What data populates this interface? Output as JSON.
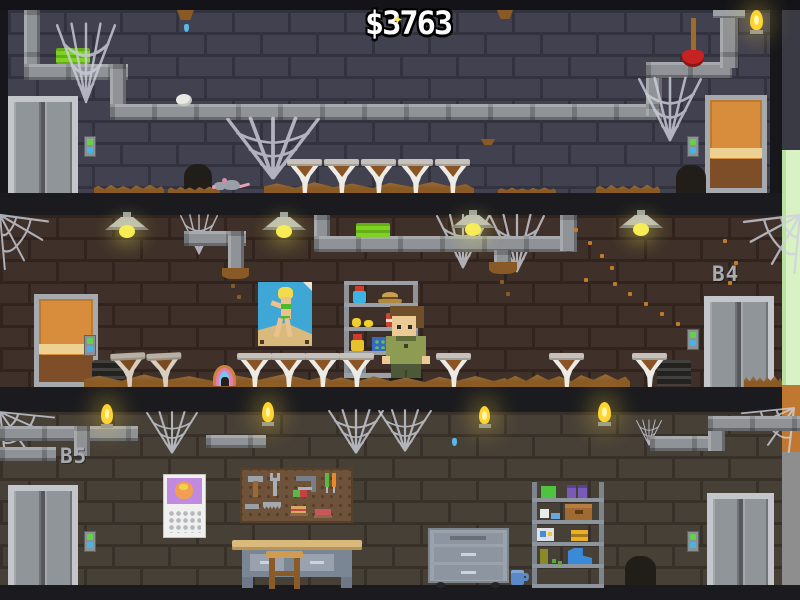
{
  "hud": {
    "money": "$3763"
  },
  "floors": {
    "top": {
      "label": ""
    },
    "middle": {
      "label": "B4"
    },
    "bottom": {
      "label": "B5"
    }
  },
  "palette": {
    "wall_top": "#414150",
    "wall_middle": "#3f3129",
    "wall_bottom": "#474037",
    "floor_band": "#1b1b1f",
    "dirt": "#8a5a24",
    "pipe": "#8f9296",
    "slime_green": "#7ed321",
    "lamp_yellow": "#f7ec55",
    "plunger_red": "#c62222",
    "door_orange": "#d78d3b",
    "elevator_gray": "#909599",
    "edge_grass": "#d8f2c4",
    "edge_dirt": "#c07830",
    "edge_stone": "#8e8e8e",
    "money_text": "#ffffff",
    "label_gray": "#a8acb2"
  },
  "scene": {
    "objects": [
      {
        "t": "pipeV",
        "n": "pipe-vertical",
        "x": 24,
        "y": 10,
        "w": 16,
        "h": 60
      },
      {
        "t": "pipeH",
        "n": "pipe-horizontal",
        "x": 24,
        "y": 64,
        "w": 104,
        "h": 16
      },
      {
        "t": "pipeV",
        "n": "pipe-vertical",
        "x": 110,
        "y": 64,
        "w": 16,
        "h": 52
      },
      {
        "t": "pipeH",
        "n": "pipe-horizontal",
        "x": 110,
        "y": 104,
        "w": 552,
        "h": 16
      },
      {
        "t": "pipeV",
        "n": "pipe-vertical",
        "x": 646,
        "y": 62,
        "w": 16,
        "h": 54
      },
      {
        "t": "pipeH",
        "n": "pipe-horizontal",
        "x": 646,
        "y": 62,
        "w": 86,
        "h": 16
      },
      {
        "t": "pipeV",
        "n": "pipe-vertical",
        "x": 720,
        "y": 10,
        "w": 18,
        "h": 58
      },
      {
        "t": "flange",
        "n": "pipe-flange",
        "x": 713,
        "y": 10,
        "w": 32,
        "h": 8
      },
      {
        "t": "sponge",
        "n": "green-slime-block",
        "x": 56,
        "y": 48,
        "w": 34,
        "h": 16,
        "i": true
      },
      {
        "t": "egg",
        "n": "spider-egg",
        "x": 176,
        "y": 94,
        "w": 16,
        "h": 12
      },
      {
        "t": "clump",
        "n": "dirt-clump",
        "x": 177,
        "y": 10,
        "w": 17,
        "h": 10
      },
      {
        "t": "clump",
        "n": "dirt-clump",
        "x": 497,
        "y": 10,
        "w": 16,
        "h": 9
      },
      {
        "t": "clump",
        "n": "dirt-clump",
        "x": 481,
        "y": 139,
        "w": 14,
        "h": 6
      },
      {
        "t": "drip",
        "n": "water-drip",
        "x": 184,
        "y": 24,
        "w": 5,
        "h": 8
      },
      {
        "t": "web",
        "v": "hang",
        "n": "spider-web",
        "x": 56,
        "y": 24,
        "w": 60,
        "h": 80
      },
      {
        "t": "web",
        "v": "hang",
        "n": "spider-web",
        "x": 226,
        "y": 118,
        "w": 94,
        "h": 62
      },
      {
        "t": "web",
        "v": "hang",
        "n": "spider-web",
        "x": 638,
        "y": 78,
        "w": 64,
        "h": 64
      },
      {
        "t": "plunger",
        "n": "plunger",
        "x": 682,
        "y": 18,
        "w": 22,
        "h": 49,
        "i": true
      },
      {
        "t": "flame",
        "n": "wall-torch-flame",
        "x": 748,
        "y": 10,
        "w": 17,
        "h": 24
      },
      {
        "t": "elev",
        "n": "elevator-door",
        "x": 8,
        "y": 96,
        "w": 70,
        "h": 97,
        "i": true
      },
      {
        "t": "btn",
        "n": "elevator-call-button",
        "x": 84,
        "y": 136,
        "w": 12,
        "h": 21,
        "i": true
      },
      {
        "t": "wdoor",
        "n": "wooden-door",
        "x": 705,
        "y": 95,
        "w": 62,
        "h": 98,
        "i": true
      },
      {
        "t": "btn",
        "n": "door-button",
        "x": 687,
        "y": 136,
        "w": 12,
        "h": 21,
        "i": true
      },
      {
        "t": "hole",
        "n": "mouse-hole",
        "x": 184,
        "y": 164,
        "w": 28,
        "h": 29
      },
      {
        "t": "hole",
        "n": "mouse-hole",
        "x": 676,
        "y": 165,
        "w": 30,
        "h": 28
      },
      {
        "t": "dirt",
        "n": "dirt-pile",
        "x": 94,
        "y": 184,
        "w": 70,
        "h": 9
      },
      {
        "t": "dirt",
        "n": "dirt-pile",
        "x": 168,
        "y": 186,
        "w": 52,
        "h": 7
      },
      {
        "t": "dirt",
        "n": "dirt-pile",
        "x": 264,
        "y": 181,
        "w": 210,
        "h": 12
      },
      {
        "t": "dirt",
        "n": "dirt-pile",
        "x": 498,
        "y": 187,
        "w": 58,
        "h": 6
      },
      {
        "t": "dirt",
        "n": "dirt-pile",
        "x": 596,
        "y": 184,
        "w": 64,
        "h": 9
      },
      {
        "t": "mouse",
        "n": "rat",
        "x": 212,
        "y": 176,
        "w": 38,
        "h": 17,
        "i": true
      },
      {
        "t": "cone",
        "n": "funnel-planter",
        "x": 287,
        "y": 157,
        "w": 35,
        "h": 36,
        "i": true
      },
      {
        "t": "cone",
        "n": "funnel-planter",
        "x": 324,
        "y": 157,
        "w": 35,
        "h": 36,
        "i": true
      },
      {
        "t": "cone",
        "n": "funnel-planter",
        "x": 361,
        "y": 157,
        "w": 35,
        "h": 36,
        "i": true
      },
      {
        "t": "cone",
        "n": "funnel-planter",
        "x": 398,
        "y": 157,
        "w": 35,
        "h": 36,
        "i": true
      },
      {
        "t": "cone",
        "n": "funnel-planter",
        "x": 435,
        "y": 157,
        "w": 35,
        "h": 36,
        "i": true
      },
      {
        "t": "web",
        "v": "tl",
        "n": "spider-web",
        "x": 0,
        "y": 215,
        "w": 48,
        "h": 54
      },
      {
        "t": "web",
        "v": "hang",
        "n": "spider-web",
        "x": 180,
        "y": 215,
        "w": 38,
        "h": 40
      },
      {
        "t": "web",
        "v": "hang",
        "n": "spider-web",
        "x": 436,
        "y": 215,
        "w": 54,
        "h": 54
      },
      {
        "t": "web",
        "v": "hang",
        "n": "spider-web",
        "x": 489,
        "y": 215,
        "w": 56,
        "h": 58
      },
      {
        "t": "web",
        "v": "tr",
        "n": "spider-web",
        "x": 744,
        "y": 215,
        "w": 56,
        "h": 58
      },
      {
        "t": "pipeH",
        "n": "pipe-horizontal",
        "x": 184,
        "y": 231,
        "w": 62,
        "h": 15
      },
      {
        "t": "pipeV",
        "n": "pipe-vertical",
        "x": 228,
        "y": 231,
        "w": 16,
        "h": 40
      },
      {
        "t": "leak",
        "n": "pipe-leak",
        "x": 222,
        "y": 268,
        "w": 27,
        "h": 11
      },
      {
        "t": "speck",
        "n": "debris-speck",
        "x": 231,
        "y": 284,
        "w": 4,
        "h": 4,
        "c": "#8a5a26"
      },
      {
        "t": "speck",
        "n": "debris-speck",
        "x": 237,
        "y": 295,
        "w": 4,
        "h": 4,
        "c": "#8a5a26"
      },
      {
        "t": "pipeV",
        "n": "pipe-vertical",
        "x": 314,
        "y": 215,
        "w": 16,
        "h": 36
      },
      {
        "t": "pipeH",
        "n": "pipe-horizontal",
        "x": 314,
        "y": 236,
        "w": 263,
        "h": 16
      },
      {
        "t": "pipeV",
        "n": "pipe-vertical",
        "x": 560,
        "y": 215,
        "w": 17,
        "h": 36
      },
      {
        "t": "pipeV",
        "n": "pipe-vertical",
        "x": 494,
        "y": 250,
        "w": 17,
        "h": 14
      },
      {
        "t": "leak",
        "n": "pipe-leak",
        "x": 489,
        "y": 262,
        "w": 28,
        "h": 12
      },
      {
        "t": "speck",
        "n": "debris-speck",
        "x": 500,
        "y": 280,
        "w": 4,
        "h": 4,
        "c": "#8a5a26"
      },
      {
        "t": "speck",
        "n": "debris-speck",
        "x": 506,
        "y": 292,
        "w": 4,
        "h": 4,
        "c": "#8a5a26"
      },
      {
        "t": "sponge",
        "n": "green-slime-block",
        "x": 356,
        "y": 223,
        "w": 34,
        "h": 14,
        "i": true
      },
      {
        "t": "lamp",
        "n": "ceiling-lamp",
        "x": 105,
        "y": 212,
        "w": 44,
        "h": 28
      },
      {
        "t": "lamp",
        "n": "ceiling-lamp",
        "x": 262,
        "y": 212,
        "w": 44,
        "h": 28
      },
      {
        "t": "lamp",
        "n": "ceiling-lamp",
        "x": 451,
        "y": 210,
        "w": 44,
        "h": 28
      },
      {
        "t": "lamp",
        "n": "ceiling-lamp",
        "x": 619,
        "y": 210,
        "w": 44,
        "h": 28
      },
      {
        "t": "speck",
        "n": "sawdust-speck",
        "x": 574,
        "y": 228,
        "w": 4,
        "h": 4,
        "c": "#c07a28"
      },
      {
        "t": "speck",
        "n": "sawdust-speck",
        "x": 588,
        "y": 241,
        "w": 4,
        "h": 4,
        "c": "#c07a28"
      },
      {
        "t": "speck",
        "n": "sawdust-speck",
        "x": 600,
        "y": 254,
        "w": 4,
        "h": 4,
        "c": "#c07a28"
      },
      {
        "t": "speck",
        "n": "sawdust-speck",
        "x": 610,
        "y": 266,
        "w": 4,
        "h": 4,
        "c": "#c07a28"
      },
      {
        "t": "speck",
        "n": "sawdust-speck",
        "x": 584,
        "y": 278,
        "w": 4,
        "h": 4,
        "c": "#c07a28"
      },
      {
        "t": "speck",
        "n": "sawdust-speck",
        "x": 613,
        "y": 282,
        "w": 4,
        "h": 4,
        "c": "#c07a28"
      },
      {
        "t": "speck",
        "n": "sawdust-speck",
        "x": 628,
        "y": 292,
        "w": 4,
        "h": 4,
        "c": "#c07a28"
      },
      {
        "t": "speck",
        "n": "sawdust-speck",
        "x": 644,
        "y": 302,
        "w": 4,
        "h": 4,
        "c": "#c07a28"
      },
      {
        "t": "speck",
        "n": "sawdust-speck",
        "x": 660,
        "y": 312,
        "w": 4,
        "h": 4,
        "c": "#c07a28"
      },
      {
        "t": "speck",
        "n": "sawdust-speck",
        "x": 676,
        "y": 322,
        "w": 4,
        "h": 4,
        "c": "#c07a28"
      },
      {
        "t": "speck",
        "n": "sawdust-speck",
        "x": 692,
        "y": 330,
        "w": 4,
        "h": 4,
        "c": "#c07a28"
      },
      {
        "t": "speck",
        "n": "sawdust-speck",
        "x": 706,
        "y": 318,
        "w": 4,
        "h": 4,
        "c": "#c07a28"
      },
      {
        "t": "speck",
        "n": "sawdust-speck",
        "x": 718,
        "y": 300,
        "w": 4,
        "h": 4,
        "c": "#c07a28"
      },
      {
        "t": "speck",
        "n": "sawdust-speck",
        "x": 728,
        "y": 281,
        "w": 4,
        "h": 4,
        "c": "#c07a28"
      },
      {
        "t": "speck",
        "n": "sawdust-speck",
        "x": 734,
        "y": 261,
        "w": 4,
        "h": 4,
        "c": "#c07a28"
      },
      {
        "t": "speck",
        "n": "sawdust-speck",
        "x": 723,
        "y": 239,
        "w": 4,
        "h": 4,
        "c": "#c07a28"
      },
      {
        "t": "wdoor",
        "n": "wooden-door",
        "x": 34,
        "y": 294,
        "w": 64,
        "h": 93,
        "i": true
      },
      {
        "t": "btn",
        "n": "door-button",
        "x": 84,
        "y": 335,
        "w": 12,
        "h": 21,
        "i": true
      },
      {
        "t": "elev",
        "n": "elevator-door",
        "x": 704,
        "y": 296,
        "w": 70,
        "h": 91,
        "i": true
      },
      {
        "t": "btn",
        "n": "elevator-call-button",
        "x": 687,
        "y": 329,
        "w": 12,
        "h": 21,
        "i": true
      },
      {
        "t": "grate",
        "n": "floor-vent",
        "x": 92,
        "y": 360,
        "w": 33,
        "h": 26
      },
      {
        "t": "grate",
        "n": "floor-vent",
        "x": 657,
        "y": 360,
        "w": 34,
        "h": 26
      },
      {
        "t": "dirt",
        "n": "dirt-pile",
        "x": 84,
        "y": 373,
        "w": 250,
        "h": 14
      },
      {
        "t": "dirt",
        "n": "dirt-pile",
        "x": 330,
        "y": 375,
        "w": 182,
        "h": 12
      },
      {
        "t": "dirt",
        "n": "dirt-pile",
        "x": 508,
        "y": 373,
        "w": 122,
        "h": 14
      },
      {
        "t": "dirt",
        "n": "dirt-pile",
        "x": 744,
        "y": 375,
        "w": 38,
        "h": 12
      },
      {
        "t": "cone",
        "v": "dirty",
        "n": "funnel-planter-dirty",
        "x": 111,
        "y": 351,
        "w": 35,
        "h": 36,
        "i": true
      },
      {
        "t": "cone",
        "v": "dirty",
        "n": "funnel-planter-dirty",
        "x": 147,
        "y": 351,
        "w": 35,
        "h": 36,
        "i": true
      },
      {
        "t": "donut",
        "n": "donut",
        "x": 213,
        "y": 365,
        "w": 23,
        "h": 21,
        "i": true
      },
      {
        "t": "cone",
        "n": "funnel-planter",
        "x": 237,
        "y": 351,
        "w": 35,
        "h": 36,
        "i": true
      },
      {
        "t": "cone",
        "n": "funnel-planter",
        "x": 271,
        "y": 351,
        "w": 35,
        "h": 36,
        "i": true
      },
      {
        "t": "cone",
        "n": "funnel-planter",
        "x": 305,
        "y": 351,
        "w": 35,
        "h": 36,
        "i": true
      },
      {
        "t": "cone",
        "n": "funnel-planter",
        "x": 339,
        "y": 351,
        "w": 35,
        "h": 36,
        "i": true
      },
      {
        "t": "cone",
        "n": "funnel-planter",
        "x": 436,
        "y": 351,
        "w": 35,
        "h": 36,
        "i": true
      },
      {
        "t": "cone",
        "n": "funnel-planter",
        "x": 549,
        "y": 351,
        "w": 35,
        "h": 36,
        "i": true
      },
      {
        "t": "cone",
        "n": "funnel-planter",
        "x": 632,
        "y": 351,
        "w": 35,
        "h": 36,
        "i": true
      },
      {
        "t": "web",
        "v": "tl",
        "n": "spider-web",
        "x": 0,
        "y": 412,
        "w": 54,
        "h": 46
      },
      {
        "t": "web",
        "v": "hang",
        "n": "spider-web",
        "x": 146,
        "y": 412,
        "w": 52,
        "h": 42
      },
      {
        "t": "web",
        "v": "hang",
        "n": "spider-web",
        "x": 328,
        "y": 410,
        "w": 56,
        "h": 44
      },
      {
        "t": "web",
        "v": "hang",
        "n": "spider-web",
        "x": 378,
        "y": 410,
        "w": 54,
        "h": 42
      },
      {
        "t": "web",
        "v": "hang",
        "n": "spider-web",
        "x": 636,
        "y": 420,
        "w": 26,
        "h": 26
      },
      {
        "t": "web",
        "v": "tr",
        "n": "spider-web",
        "x": 742,
        "y": 408,
        "w": 52,
        "h": 44
      },
      {
        "t": "pipeH",
        "n": "pipe-horizontal",
        "x": 0,
        "y": 426,
        "w": 138,
        "h": 15
      },
      {
        "t": "pipeV",
        "n": "pipe-vertical",
        "x": 74,
        "y": 426,
        "w": 16,
        "h": 30
      },
      {
        "t": "pipeH",
        "n": "pipe-horizontal",
        "x": 0,
        "y": 447,
        "w": 56,
        "h": 14
      },
      {
        "t": "pipeH",
        "n": "pipe-horizontal",
        "x": 206,
        "y": 435,
        "w": 60,
        "h": 13
      },
      {
        "t": "pipeH",
        "n": "pipe-horiz",
        "x": 650,
        "y": 436,
        "w": 74,
        "h": 15
      },
      {
        "t": "pipeV",
        "n": "pipe-vertical",
        "x": 708,
        "y": 416,
        "w": 17,
        "h": 35
      },
      {
        "t": "pipeH",
        "n": "pipe-horizontal",
        "x": 708,
        "y": 416,
        "w": 92,
        "h": 15
      },
      {
        "t": "flame",
        "n": "wall-torch-flame",
        "x": 99,
        "y": 404,
        "w": 16,
        "h": 24
      },
      {
        "t": "flame",
        "n": "wall-torch-flame",
        "x": 260,
        "y": 402,
        "w": 16,
        "h": 24
      },
      {
        "t": "flame",
        "n": "wall-torch-flame",
        "x": 477,
        "y": 406,
        "w": 15,
        "h": 22
      },
      {
        "t": "flame",
        "n": "wall-torch-flame",
        "x": 596,
        "y": 402,
        "w": 17,
        "h": 24
      },
      {
        "t": "drip",
        "n": "water-drip",
        "x": 452,
        "y": 438,
        "w": 5,
        "h": 8
      },
      {
        "t": "elev",
        "n": "elevator-door",
        "x": 8,
        "y": 485,
        "w": 70,
        "h": 100,
        "i": true
      },
      {
        "t": "btn",
        "n": "elevator-call-button",
        "x": 84,
        "y": 531,
        "w": 12,
        "h": 21,
        "i": true
      },
      {
        "t": "elev",
        "n": "elevator-door",
        "x": 707,
        "y": 493,
        "w": 67,
        "h": 92,
        "i": true
      },
      {
        "t": "btn",
        "n": "elevator-call-button",
        "x": 687,
        "y": 531,
        "w": 12,
        "h": 21,
        "i": true
      },
      {
        "t": "hole",
        "n": "floor-hole",
        "x": 625,
        "y": 556,
        "w": 31,
        "h": 29
      },
      {
        "t": "mug",
        "n": "mug",
        "x": 511,
        "y": 570,
        "w": 18,
        "h": 15
      }
    ]
  }
}
